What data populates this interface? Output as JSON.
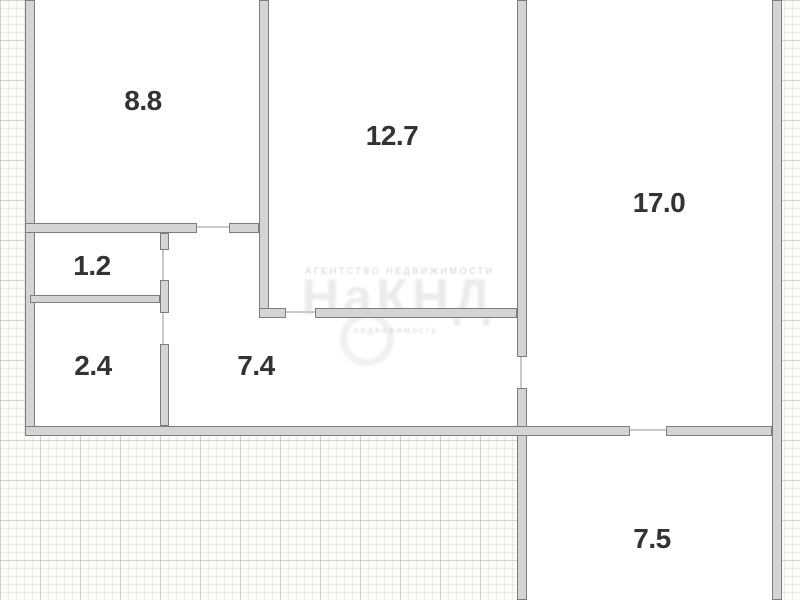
{
  "type": "apartment-floor-plan",
  "rooms": [
    {
      "id": "room-top-left",
      "area_label": "8.8"
    },
    {
      "id": "room-top-middle",
      "area_label": "12.7"
    },
    {
      "id": "room-right",
      "area_label": "17.0"
    },
    {
      "id": "room-vestibule",
      "area_label": "1.2"
    },
    {
      "id": "room-storage",
      "area_label": "2.4"
    },
    {
      "id": "room-hallway",
      "area_label": "7.4"
    },
    {
      "id": "room-bottom-right",
      "area_label": "7.5"
    }
  ],
  "watermark": {
    "line1": "АГЕНТСТВО НЕДВИЖИМОСТИ",
    "big": "НаКНД",
    "line2": "недвижимость"
  },
  "colors": {
    "wall_fill": "#d4d4d4",
    "wall_edge": "#7d7d7d",
    "label_text": "#333333",
    "exterior_grid_bg": "#fcfcf9",
    "interior_bg": "#ffffff"
  }
}
